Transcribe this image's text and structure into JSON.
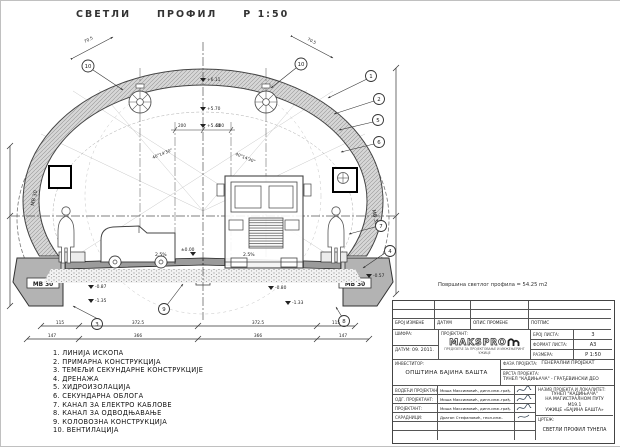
{
  "title": {
    "word1": "СВЕТЛИ",
    "word2": "ПРОФИЛ",
    "scale": "Р 1:50"
  },
  "note": "Површина светлог профила = 54.25 m2",
  "legend": {
    "items": [
      "1.  ЛИНИЈА  ИСКОПА",
      "2.  ПРИМАРНА КОНСТРУКЦИЈА",
      "3.  ТЕМЕЉИ  СЕКУНДАРНЕ КОНСТРУКЦИЈЕ",
      "4.  ДРЕНАЖА",
      "5.  ХИДРОИЗОЛАЦИЈА",
      "6.  СЕКУНДАРНА ОБЛОГА",
      "7.  КАНАЛ  ЗА  ЕЛЕКТРО  КАБЛОВЕ",
      "8.  КАНАЛ ЗА ОДВОДЊАВАЊЕ",
      "9.  КОЛОВОЗНА  КОНСТРУКЦИЈА",
      "10. ВЕНТИЛАЦИЈА"
    ]
  },
  "drawing": {
    "mb30": "МВ 30",
    "slope_left": "2.5%",
    "slope_right": "2.5%",
    "elev_611": "+6.11",
    "elev_570": "+5.70",
    "elev_540": "+5.40",
    "elev_000": "±0.00",
    "elev_m080": "-0.80",
    "elev_m057": "-0.57",
    "elev_m087": "-0.87",
    "elev_m135": "-1.35",
    "elev_m133": "-1.33",
    "dim_200a": "200",
    "dim_200b": "200",
    "dim_705a": "70.5",
    "dim_705b": "70.5",
    "angle_left": "40°14'30\"",
    "angle_right": "40°14'30\"",
    "callouts": {
      "c1": "1",
      "c2": "2",
      "c3": "3",
      "c4": "4",
      "c5": "5",
      "c6": "6",
      "c7": "7",
      "c8": "8",
      "c9": "9",
      "c10": "10"
    },
    "dims_row1": [
      "115",
      "372.5",
      "372.5",
      "115"
    ],
    "dims_row2": [
      "147",
      "366",
      "366",
      "147"
    ]
  },
  "titleblock": {
    "rev_headers": [
      "БРОЈ  ИЗМЕНЕ",
      "ДАТУМ",
      "ОПИС  ПРОМЕНЕ",
      "ПОТПИС"
    ],
    "code_label": "ШИФРА:",
    "date_label": "ДАТУМ:",
    "date_value": "09. 2011.",
    "designer_label": "ПРОЈЕКТАНТ:",
    "logo_text": "MAKSPRO",
    "logo_sub1": "ПРЕДУЗЕЋЕ ЗА ПРОЈЕКТОВАЊЕ И ИНЖЕЊЕРИНГ",
    "logo_sub2": "УЖИЦЕ",
    "sheet_no_label": "БРОЈ ЛИСТА:",
    "sheet_no": "3",
    "format_label": "ФОРМАТ ЛИСТА:",
    "format": "А3",
    "scale_label": "РАЗМЕРА:",
    "scale": "Р 1:50",
    "investor_label": "ИНВЕСТИТОР:",
    "investor": "ОПШТИНА  БАЈИНА  БАШТА",
    "phase_label": "ФАЗА ПРОЈЕКТА:",
    "phase": "ГЕНЕРАЛНИ ПРОЈЕКАТ",
    "type_label": "ВРСТА ПРОЈЕКТА:",
    "type": "ТУНЕЛ \"КАДИЊАЧА\" - ГРАЂЕВИНСКИ ДЕО",
    "staff": [
      {
        "role": "ВОДЕЋИ ПРОЈЕКТАНТ:",
        "name": "Миша Максимовић, дипл.инж.грађ."
      },
      {
        "role": "ОДГ. ПРОЈЕКТАНТ:",
        "name": "Миша Максимовић, дипл.инж.грађ."
      },
      {
        "role": "ПРОЈЕКТАНТ:",
        "name": "Миша Максимовић, дипл.инж.грађ."
      },
      {
        "role": "САРАДНИЦИ:",
        "name": "Драган Стефановић, геол.инж."
      }
    ],
    "project_name_label": "НАЗИВ ПРОЈЕКТА И ЛОКАЛИТЕТ:",
    "project_name_lines": [
      "ТУНЕЛ \"КАДИЊАЧА\"",
      "НА МАГИСТРАЛНОМ ПУТУ М19.1",
      "УЖИЦЕ «БАЈИНА БАШТА»"
    ],
    "drawing_label": "ЦРТЕЖ:",
    "drawing_name": "СВЕТЛИ ПРОФИЛ ТУНЕЛА"
  }
}
